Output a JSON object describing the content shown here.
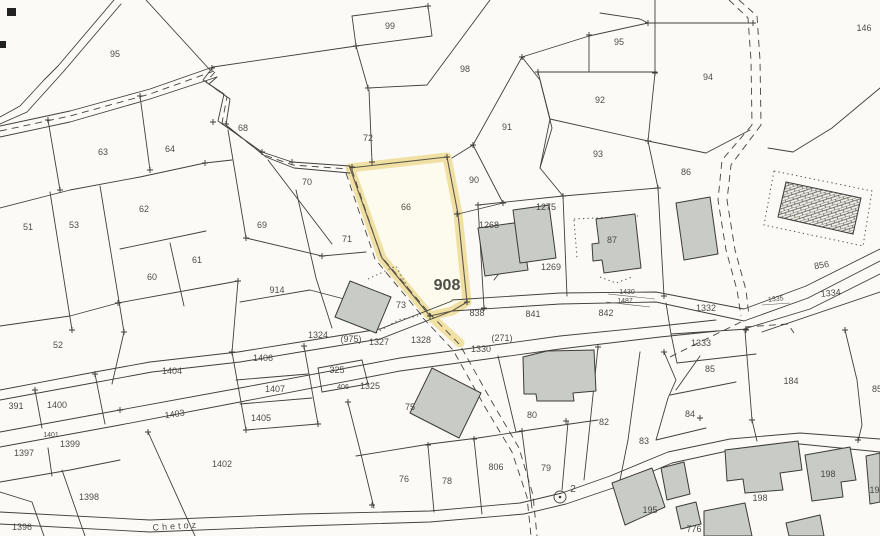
{
  "map": {
    "type": "cadastral-parcel-plan",
    "highlighted_parcel": "908",
    "street_name": "Chetoz",
    "survey_point_label": "2",
    "colors": {
      "background": "#fbfaf6",
      "line": "#40403a",
      "building_fill": "#c9cbc7",
      "highlight_halo": "#f0dfa0",
      "highlight_fill": "#fefced",
      "label": "#3a3a34"
    },
    "labels": [
      {
        "t": "95",
        "x": 115,
        "y": 57
      },
      {
        "t": "99",
        "x": 390,
        "y": 29
      },
      {
        "t": "98",
        "x": 465,
        "y": 72
      },
      {
        "t": "95",
        "x": 619,
        "y": 45
      },
      {
        "t": "94",
        "x": 708,
        "y": 80
      },
      {
        "t": "146",
        "x": 864,
        "y": 31
      },
      {
        "t": "92",
        "x": 600,
        "y": 103
      },
      {
        "t": "91",
        "x": 507,
        "y": 130
      },
      {
        "t": "93",
        "x": 598,
        "y": 157
      },
      {
        "t": "72",
        "x": 368,
        "y": 141
      },
      {
        "t": "86",
        "x": 686,
        "y": 175
      },
      {
        "t": "63",
        "x": 103,
        "y": 155
      },
      {
        "t": "64",
        "x": 170,
        "y": 152
      },
      {
        "t": "68",
        "x": 243,
        "y": 131
      },
      {
        "t": "70",
        "x": 307,
        "y": 185
      },
      {
        "t": "69",
        "x": 262,
        "y": 228
      },
      {
        "t": "66",
        "x": 406,
        "y": 210
      },
      {
        "t": "51",
        "x": 28,
        "y": 230
      },
      {
        "t": "53",
        "x": 74,
        "y": 228
      },
      {
        "t": "62",
        "x": 144,
        "y": 212
      },
      {
        "t": "60",
        "x": 152,
        "y": 280
      },
      {
        "t": "61",
        "x": 197,
        "y": 263
      },
      {
        "t": "71",
        "x": 347,
        "y": 242
      },
      {
        "t": "90",
        "x": 474,
        "y": 183
      },
      {
        "t": "1275",
        "x": 546,
        "y": 210
      },
      {
        "t": "1268",
        "x": 489,
        "y": 228
      },
      {
        "t": "87",
        "x": 612,
        "y": 243
      },
      {
        "t": "1269",
        "x": 551,
        "y": 270
      },
      {
        "t": "914",
        "x": 277,
        "y": 293
      },
      {
        "t": "52",
        "x": 58,
        "y": 348
      },
      {
        "t": "73",
        "x": 401,
        "y": 308
      },
      {
        "t": "908",
        "x": 447,
        "y": 290,
        "s": 16,
        "b": 1
      },
      {
        "t": "838",
        "x": 477,
        "y": 316
      },
      {
        "t": "841",
        "x": 533,
        "y": 317
      },
      {
        "t": "842",
        "x": 606,
        "y": 316
      },
      {
        "t": "1430",
        "x": 627,
        "y": 294,
        "s": 7
      },
      {
        "t": "1487",
        "x": 625,
        "y": 303,
        "s": 7
      },
      {
        "t": "856",
        "x": 822,
        "y": 268,
        "r": -9
      },
      {
        "t": "1334",
        "x": 831,
        "y": 296,
        "r": -6
      },
      {
        "t": "1335",
        "x": 776,
        "y": 301,
        "s": 7,
        "r": -6
      },
      {
        "t": "1332",
        "x": 706,
        "y": 311
      },
      {
        "t": "1333",
        "x": 701,
        "y": 346
      },
      {
        "t": "1324",
        "x": 318,
        "y": 338
      },
      {
        "t": "(975)",
        "x": 351,
        "y": 342
      },
      {
        "t": "1327",
        "x": 379,
        "y": 345
      },
      {
        "t": "1328",
        "x": 421,
        "y": 343
      },
      {
        "t": "1330",
        "x": 481,
        "y": 352
      },
      {
        "t": "(271)",
        "x": 502,
        "y": 341
      },
      {
        "t": "1406",
        "x": 263,
        "y": 361
      },
      {
        "t": "1404",
        "x": 172,
        "y": 374
      },
      {
        "t": "1407",
        "x": 275,
        "y": 392
      },
      {
        "t": "1403",
        "x": 175,
        "y": 417,
        "r": -8
      },
      {
        "t": "1405",
        "x": 261,
        "y": 421
      },
      {
        "t": "391",
        "x": 16,
        "y": 409
      },
      {
        "t": "1400",
        "x": 57,
        "y": 408
      },
      {
        "t": "1401",
        "x": 51,
        "y": 437,
        "s": 7
      },
      {
        "t": "1399",
        "x": 70,
        "y": 447
      },
      {
        "t": "1397",
        "x": 24,
        "y": 456
      },
      {
        "t": "1402",
        "x": 222,
        "y": 467
      },
      {
        "t": "1398",
        "x": 89,
        "y": 500
      },
      {
        "t": "1396",
        "x": 22,
        "y": 530
      },
      {
        "t": "325",
        "x": 337,
        "y": 373
      },
      {
        "t": "406",
        "x": 343,
        "y": 389,
        "s": 7
      },
      {
        "t": "1325",
        "x": 370,
        "y": 389
      },
      {
        "t": "75",
        "x": 410,
        "y": 410
      },
      {
        "t": "76",
        "x": 404,
        "y": 482
      },
      {
        "t": "78",
        "x": 447,
        "y": 484
      },
      {
        "t": "806",
        "x": 496,
        "y": 470
      },
      {
        "t": "79",
        "x": 546,
        "y": 471
      },
      {
        "t": "80",
        "x": 532,
        "y": 418
      },
      {
        "t": "2",
        "x": 573,
        "y": 492,
        "s": 10
      },
      {
        "t": "82",
        "x": 604,
        "y": 425
      },
      {
        "t": "83",
        "x": 644,
        "y": 444
      },
      {
        "t": "84",
        "x": 690,
        "y": 417
      },
      {
        "t": "85",
        "x": 710,
        "y": 372
      },
      {
        "t": "184",
        "x": 791,
        "y": 384
      },
      {
        "t": "85",
        "x": 877,
        "y": 392
      },
      {
        "t": "195",
        "x": 650,
        "y": 513
      },
      {
        "t": "198",
        "x": 760,
        "y": 501
      },
      {
        "t": "198",
        "x": 828,
        "y": 477
      },
      {
        "t": "199",
        "x": 877,
        "y": 493
      },
      {
        "t": "776",
        "x": 694,
        "y": 532
      },
      {
        "t": "Chetoz",
        "x": 176,
        "y": 529,
        "r": -4,
        "ls": 3
      }
    ]
  }
}
